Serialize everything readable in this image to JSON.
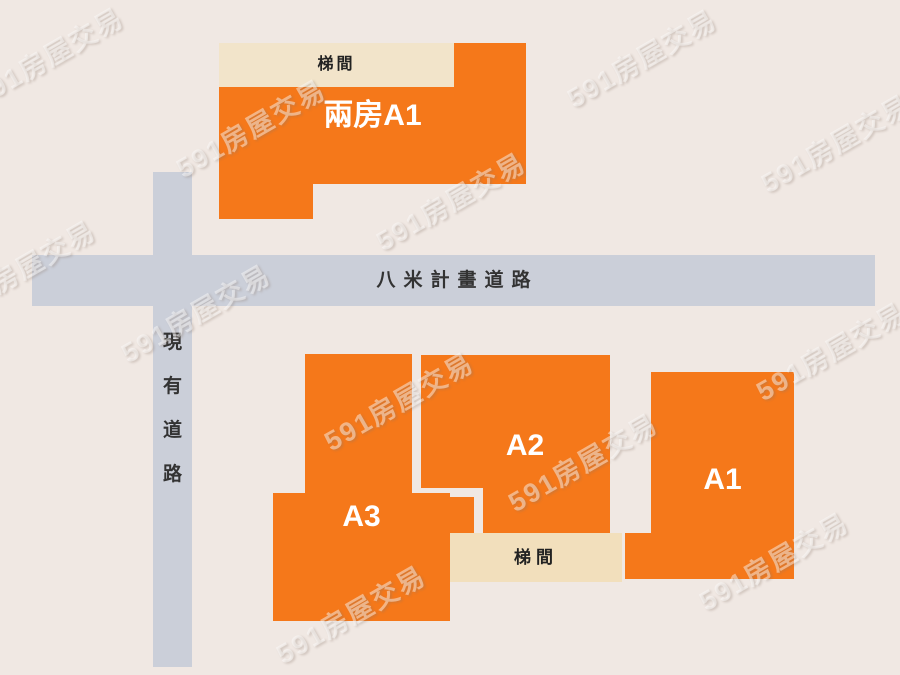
{
  "watermark": {
    "text": "591房屋交易"
  },
  "roads": {
    "horizontal": {
      "label": "八米計畫道路"
    },
    "vertical": {
      "label": "現有道路",
      "chars": [
        "現",
        "有",
        "道",
        "路"
      ]
    }
  },
  "buildings": {
    "top": {
      "unit_label": "兩房A1",
      "stair_label": "梯間"
    },
    "a3": {
      "label": "A3"
    },
    "a2": {
      "label": "A2"
    },
    "a1": {
      "label": "A1"
    },
    "stair_bottom": {
      "label": "梯間"
    }
  },
  "colors": {
    "background": "#F0E8E3",
    "building_orange": "#F5781A",
    "stairwell_cream_top": "#F2E4CA",
    "stairwell_cream_bottom": "#F2DFBC",
    "road_gray": "#CBCFD9",
    "label_dark": "#333333",
    "label_white": "#FFFFFF"
  }
}
